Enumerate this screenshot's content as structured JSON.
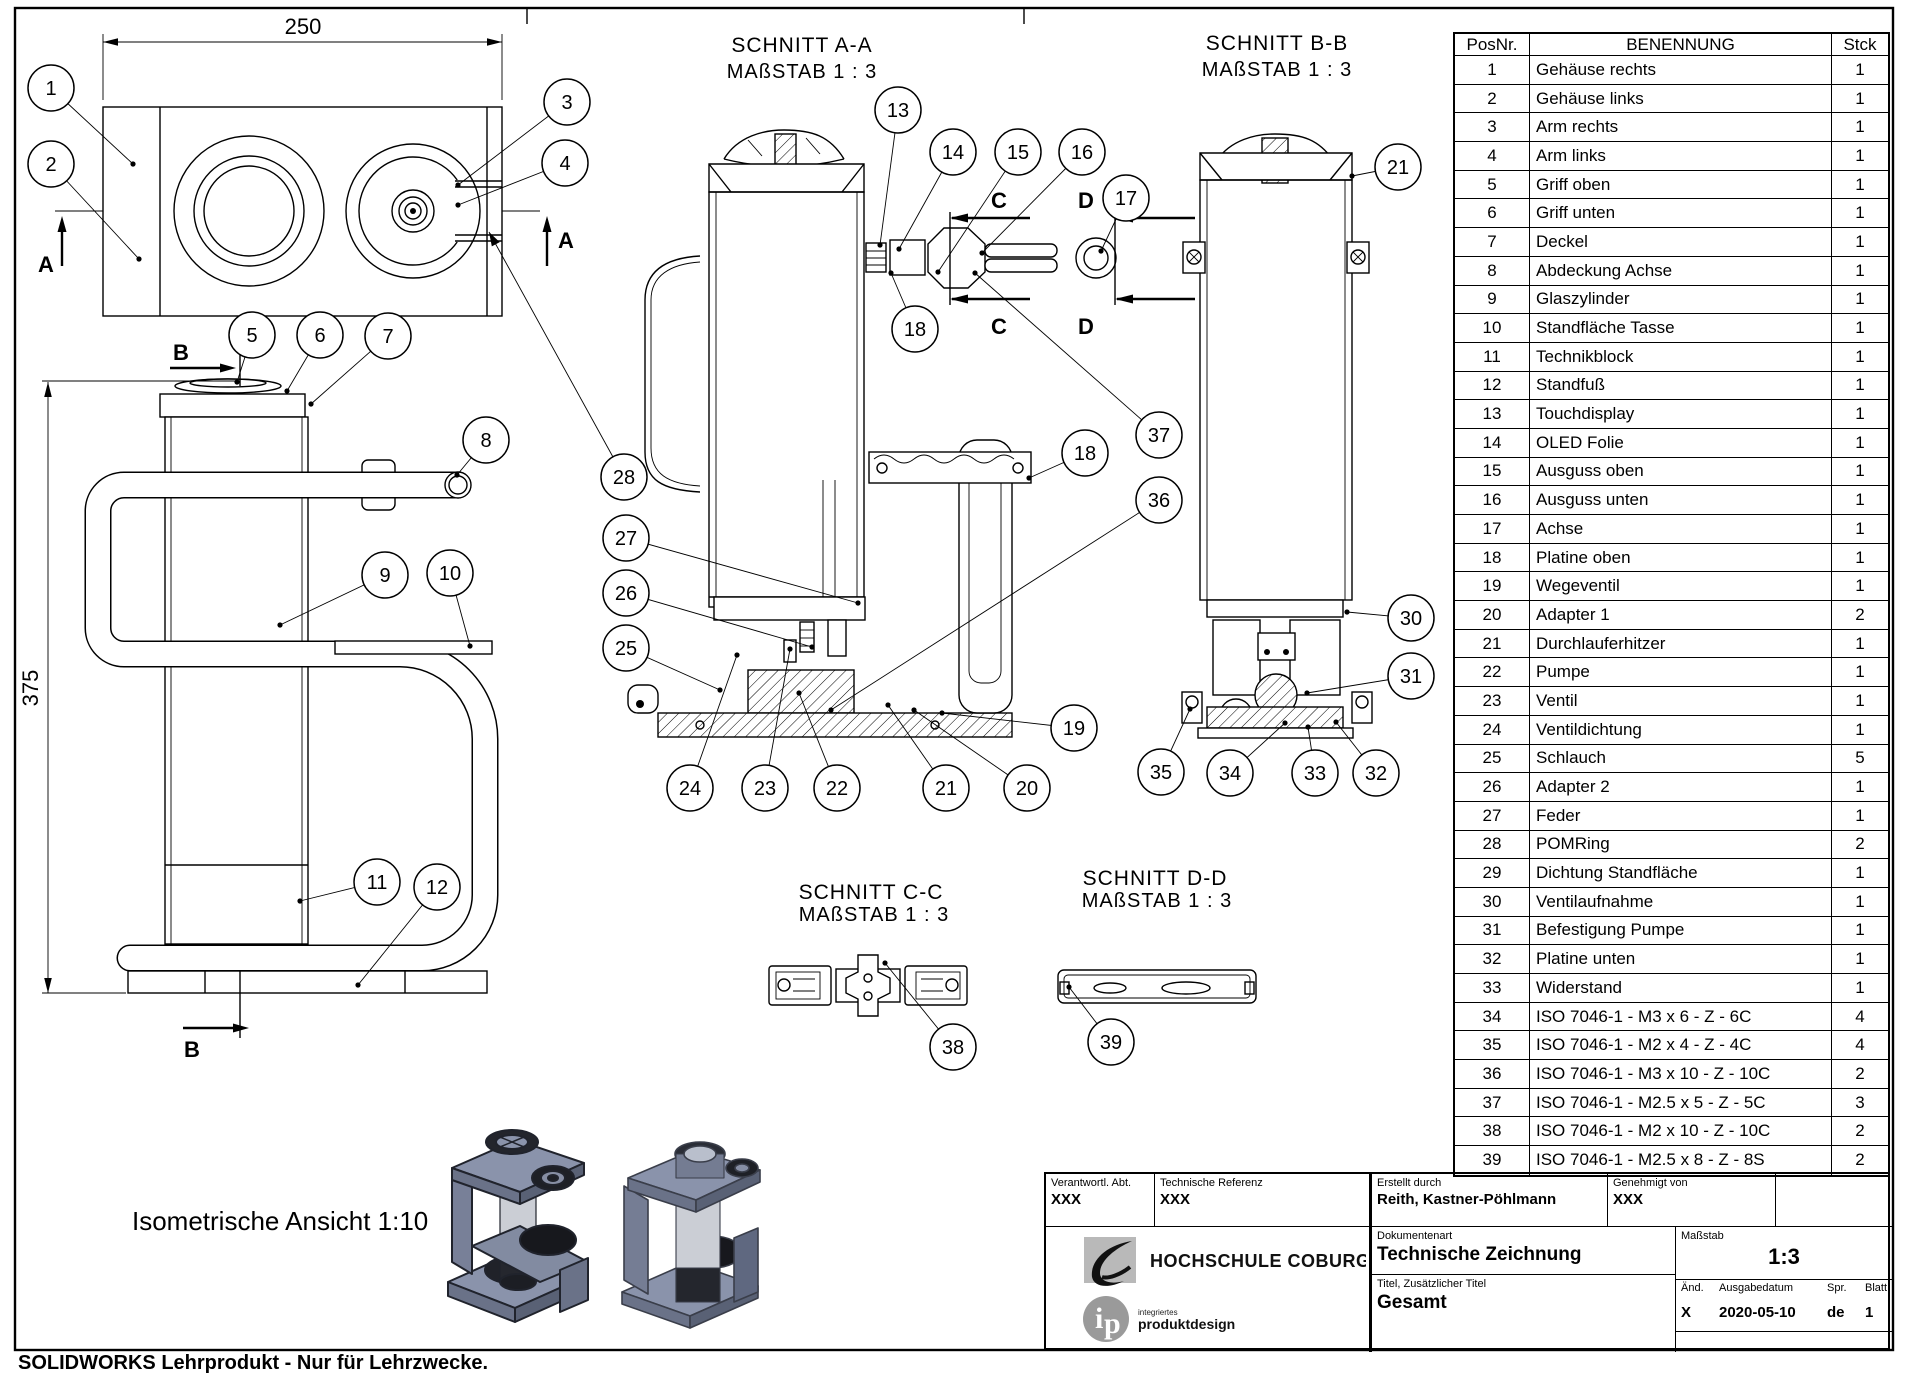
{
  "sheet": {
    "footer": "SOLIDWORKS Lehrprodukt - Nur für Lehrzwecke."
  },
  "views": {
    "top": {
      "dim_width": "250",
      "section_label": "A"
    },
    "front": {
      "dim_height": "375",
      "section_label": "B"
    },
    "section_aa": {
      "title": "SCHNITT A-A",
      "scale": "MAßSTAB 1 : 3",
      "marker_c": "C",
      "marker_d": "D"
    },
    "section_bb": {
      "title": "SCHNITT B-B",
      "scale": "MAßSTAB 1 : 3"
    },
    "section_cc": {
      "title": "SCHNITT C-C",
      "scale": "MAßSTAB 1 : 3"
    },
    "section_dd": {
      "title": "SCHNITT D-D",
      "scale": "MAßSTAB 1 : 3"
    },
    "isometric": {
      "caption": "Isometrische Ansicht 1:10"
    }
  },
  "balloons": [
    {
      "n": "1",
      "cx": 51,
      "cy": 88,
      "tx": 133,
      "ty": 164,
      "end": "dot"
    },
    {
      "n": "2",
      "cx": 51,
      "cy": 164,
      "tx": 139,
      "ty": 259,
      "end": "dot"
    },
    {
      "n": "3",
      "cx": 567,
      "cy": 102,
      "tx": 458,
      "ty": 185,
      "end": "dot"
    },
    {
      "n": "4",
      "cx": 565,
      "cy": 163,
      "tx": 458,
      "ty": 205,
      "end": "dot"
    },
    {
      "n": "28",
      "cx": 624,
      "cy": 477,
      "tx": 489,
      "ty": 232,
      "end": "arrow"
    },
    {
      "n": "5",
      "cx": 252,
      "cy": 335,
      "tx": 237,
      "ty": 382,
      "end": "dot"
    },
    {
      "n": "6",
      "cx": 320,
      "cy": 335,
      "tx": 287,
      "ty": 391,
      "end": "dot"
    },
    {
      "n": "7",
      "cx": 388,
      "cy": 336,
      "tx": 311,
      "ty": 404,
      "end": "dot"
    },
    {
      "n": "8",
      "cx": 486,
      "cy": 440,
      "tx": 457,
      "ty": 475,
      "end": "dot"
    },
    {
      "n": "9",
      "cx": 385,
      "cy": 575,
      "tx": 280,
      "ty": 625,
      "end": "dot"
    },
    {
      "n": "10",
      "cx": 450,
      "cy": 573,
      "tx": 470,
      "ty": 646,
      "end": "dot"
    },
    {
      "n": "11",
      "cx": 377,
      "cy": 882,
      "tx": 300,
      "ty": 901,
      "end": "dot"
    },
    {
      "n": "12",
      "cx": 437,
      "cy": 887,
      "tx": 358,
      "ty": 985,
      "end": "dot"
    },
    {
      "n": "13",
      "cx": 898,
      "cy": 110,
      "tx": 880,
      "ty": 245,
      "end": "dot"
    },
    {
      "n": "14",
      "cx": 953,
      "cy": 152,
      "tx": 899,
      "ty": 249,
      "end": "dot"
    },
    {
      "n": "15",
      "cx": 1018,
      "cy": 152,
      "tx": 938,
      "ty": 272,
      "end": "dot"
    },
    {
      "n": "16",
      "cx": 1082,
      "cy": 152,
      "tx": 982,
      "ty": 253,
      "end": "dot"
    },
    {
      "n": "17",
      "cx": 1126,
      "cy": 198,
      "tx": 1101,
      "ty": 251,
      "end": "dot"
    },
    {
      "n": "18",
      "cx": 915,
      "cy": 329,
      "tx": 891,
      "ty": 273,
      "end": "dot"
    },
    {
      "n": "18",
      "cx": 1085,
      "cy": 453,
      "tx": 1029,
      "ty": 478,
      "end": "dot"
    },
    {
      "n": "19",
      "cx": 1074,
      "cy": 728,
      "tx": 942,
      "ty": 713,
      "end": "dot"
    },
    {
      "n": "20",
      "cx": 1027,
      "cy": 788,
      "tx": 914,
      "ty": 710,
      "end": "dot"
    },
    {
      "n": "21",
      "cx": 946,
      "cy": 788,
      "tx": 888,
      "ty": 705,
      "end": "dot"
    },
    {
      "n": "22",
      "cx": 837,
      "cy": 788,
      "tx": 799,
      "ty": 693,
      "end": "dot"
    },
    {
      "n": "23",
      "cx": 765,
      "cy": 788,
      "tx": 790,
      "ty": 649,
      "end": "dot"
    },
    {
      "n": "24",
      "cx": 690,
      "cy": 788,
      "tx": 737,
      "ty": 655,
      "end": "dot"
    },
    {
      "n": "25",
      "cx": 626,
      "cy": 648,
      "tx": 720,
      "ty": 690,
      "end": "dot"
    },
    {
      "n": "26",
      "cx": 626,
      "cy": 593,
      "tx": 812,
      "ty": 647,
      "end": "dot"
    },
    {
      "n": "27",
      "cx": 626,
      "cy": 538,
      "tx": 858,
      "ty": 603,
      "end": "dot"
    },
    {
      "n": "36",
      "cx": 1159,
      "cy": 500,
      "tx": 831,
      "ty": 710,
      "end": "dot"
    },
    {
      "n": "37",
      "cx": 1159,
      "cy": 435,
      "tx": 975,
      "ty": 273,
      "end": "dot"
    },
    {
      "n": "35",
      "cx": 1161,
      "cy": 772,
      "tx": 1190,
      "ty": 709,
      "end": "dot"
    },
    {
      "n": "34",
      "cx": 1230,
      "cy": 773,
      "tx": 1285,
      "ty": 723,
      "end": "dot"
    },
    {
      "n": "33",
      "cx": 1315,
      "cy": 773,
      "tx": 1308,
      "ty": 727,
      "end": "dot"
    },
    {
      "n": "32",
      "cx": 1376,
      "cy": 773,
      "tx": 1336,
      "ty": 722,
      "end": "dot"
    },
    {
      "n": "21",
      "cx": 1398,
      "cy": 167,
      "tx": 1352,
      "ty": 176,
      "end": "dot"
    },
    {
      "n": "30",
      "cx": 1411,
      "cy": 618,
      "tx": 1347,
      "ty": 612,
      "end": "dot"
    },
    {
      "n": "31",
      "cx": 1411,
      "cy": 676,
      "tx": 1307,
      "ty": 693,
      "end": "dot"
    },
    {
      "n": "38",
      "cx": 953,
      "cy": 1047,
      "tx": 885,
      "ty": 963,
      "end": "dot"
    },
    {
      "n": "39",
      "cx": 1111,
      "cy": 1042,
      "tx": 1069,
      "ty": 987,
      "end": "dot"
    }
  ],
  "parts_list": {
    "headers": [
      "PosNr.",
      "BENENNUNG",
      "Stck"
    ],
    "rows": [
      [
        "1",
        "Gehäuse rechts",
        "1"
      ],
      [
        "2",
        "Gehäuse links",
        "1"
      ],
      [
        "3",
        "Arm rechts",
        "1"
      ],
      [
        "4",
        "Arm links",
        "1"
      ],
      [
        "5",
        "Griff oben",
        "1"
      ],
      [
        "6",
        "Griff unten",
        "1"
      ],
      [
        "7",
        "Deckel",
        "1"
      ],
      [
        "8",
        "Abdeckung Achse",
        "1"
      ],
      [
        "9",
        "Glaszylinder",
        "1"
      ],
      [
        "10",
        "Standfläche Tasse",
        "1"
      ],
      [
        "11",
        "Technikblock",
        "1"
      ],
      [
        "12",
        "Standfuß",
        "1"
      ],
      [
        "13",
        "Touchdisplay",
        "1"
      ],
      [
        "14",
        "OLED Folie",
        "1"
      ],
      [
        "15",
        "Ausguss oben",
        "1"
      ],
      [
        "16",
        "Ausguss unten",
        "1"
      ],
      [
        "17",
        "Achse",
        "1"
      ],
      [
        "18",
        "Platine oben",
        "1"
      ],
      [
        "19",
        "Wegeventil",
        "1"
      ],
      [
        "20",
        "Adapter 1",
        "2"
      ],
      [
        "21",
        "Durchlauferhitzer",
        "1"
      ],
      [
        "22",
        "Pumpe",
        "1"
      ],
      [
        "23",
        "Ventil",
        "1"
      ],
      [
        "24",
        "Ventildichtung",
        "1"
      ],
      [
        "25",
        "Schlauch",
        "5"
      ],
      [
        "26",
        "Adapter 2",
        "1"
      ],
      [
        "27",
        "Feder",
        "1"
      ],
      [
        "28",
        "POMRing",
        "2"
      ],
      [
        "29",
        "Dichtung Standfläche",
        "1"
      ],
      [
        "30",
        "Ventilaufnahme",
        "1"
      ],
      [
        "31",
        "Befestigung Pumpe",
        "1"
      ],
      [
        "32",
        "Platine unten",
        "1"
      ],
      [
        "33",
        "Widerstand",
        "1"
      ],
      [
        "34",
        "ISO 7046-1 - M3 x 6 - Z - 6C",
        "4"
      ],
      [
        "35",
        "ISO 7046-1 - M2 x 4 - Z - 4C",
        "4"
      ],
      [
        "36",
        "ISO 7046-1 - M3 x 10 - Z - 10C",
        "2"
      ],
      [
        "37",
        "ISO 7046-1 - M2.5 x 5 - Z - 5C",
        "3"
      ],
      [
        "38",
        "ISO 7046-1 - M2 x 10 - Z - 10C",
        "2"
      ],
      [
        "39",
        "ISO 7046-1 - M2.5 x 8 - Z - 8S",
        "2"
      ]
    ]
  },
  "title_block": {
    "responsible_dept_label": "Verantwortl. Abt.",
    "responsible_dept": "XXX",
    "technical_reference_label": "Technische Referenz",
    "technical_reference": "XXX",
    "created_by_label": "Erstellt durch",
    "created_by": "Reith, Kastner-Pöhlmann",
    "approved_by_label": "Genehmigt von",
    "approved_by": "XXX",
    "logo_name": "HOCHSCHULE COBURG",
    "logo_sub_top": "integriertes",
    "logo_sub_bottom": "produktdesign",
    "document_type_label": "Dokumentenart",
    "document_type": "Technische Zeichnung",
    "title_label": "Titel, Zusätzlicher Titel",
    "title": "Gesamt",
    "scale_label": "Maßstab",
    "scale": "1:3",
    "rev_label": "Änd.",
    "date_label": "Ausgabedatum",
    "lang_label": "Spr.",
    "sheet_label": "Blatt",
    "rev": "X",
    "date": "2020-05-10",
    "lang": "de",
    "sheet_no": "1"
  },
  "colors": {
    "line": "#000000",
    "render_face": "#8a93ab",
    "render_side": "#6a7288",
    "render_dark": "#1e2026",
    "glass": "#cbced5"
  }
}
